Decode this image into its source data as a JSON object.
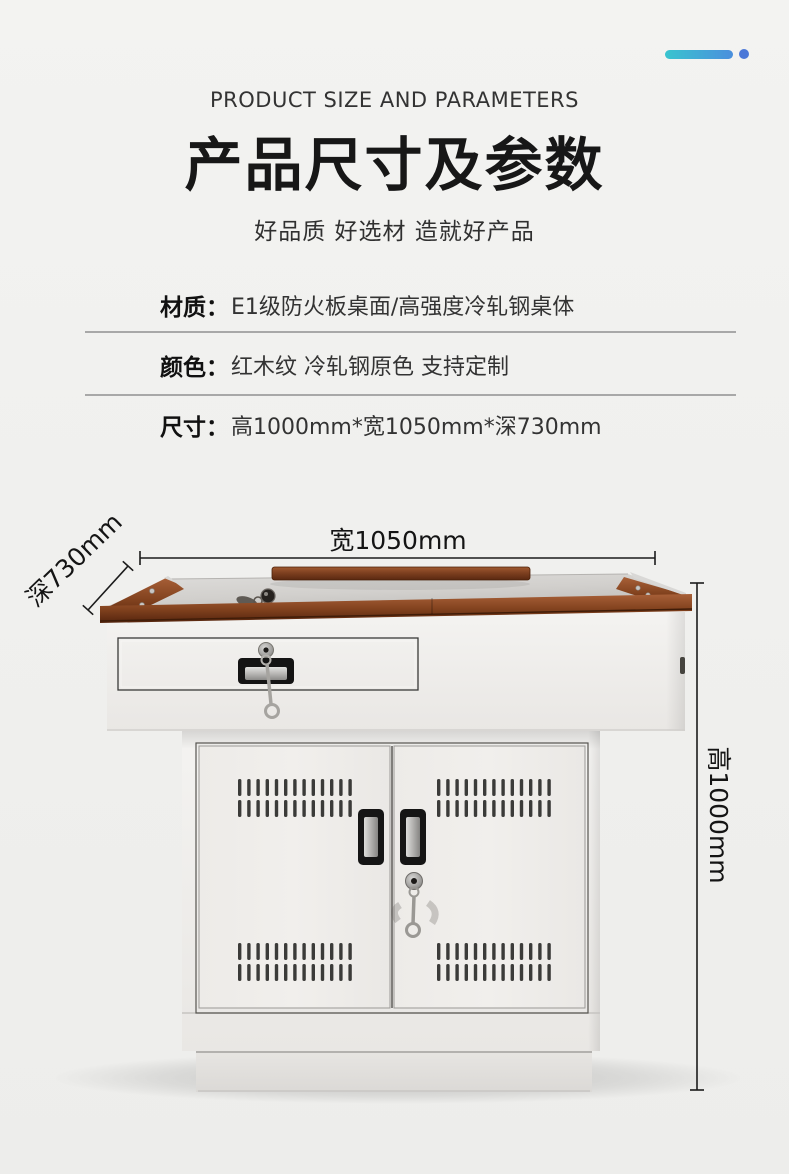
{
  "decor": {
    "accent_gradient_start": "#39c4cf",
    "accent_gradient_end": "#4b8fdd",
    "accent_dot_color": "#4b78d8"
  },
  "header": {
    "eyebrow": "PRODUCT SIZE AND PARAMETERS",
    "title": "产品尺寸及参数",
    "subtitle": "好品质 好选材 造就好产品"
  },
  "specs": [
    {
      "label": "材质：",
      "value": "E1级防火板桌面/高强度冷轧钢桌体"
    },
    {
      "label": "颜色：",
      "value": "红木纹 冷轧钢原色  支持定制"
    },
    {
      "label": "尺寸：",
      "value": "高1000mm*宽1050mm*深730mm"
    }
  ],
  "figure": {
    "dimension_width": "宽1050mm",
    "dimension_depth": "深730mm",
    "dimension_height": "高1000mm",
    "wood_color": "#8c4a26",
    "steel_color": "#efedea"
  }
}
